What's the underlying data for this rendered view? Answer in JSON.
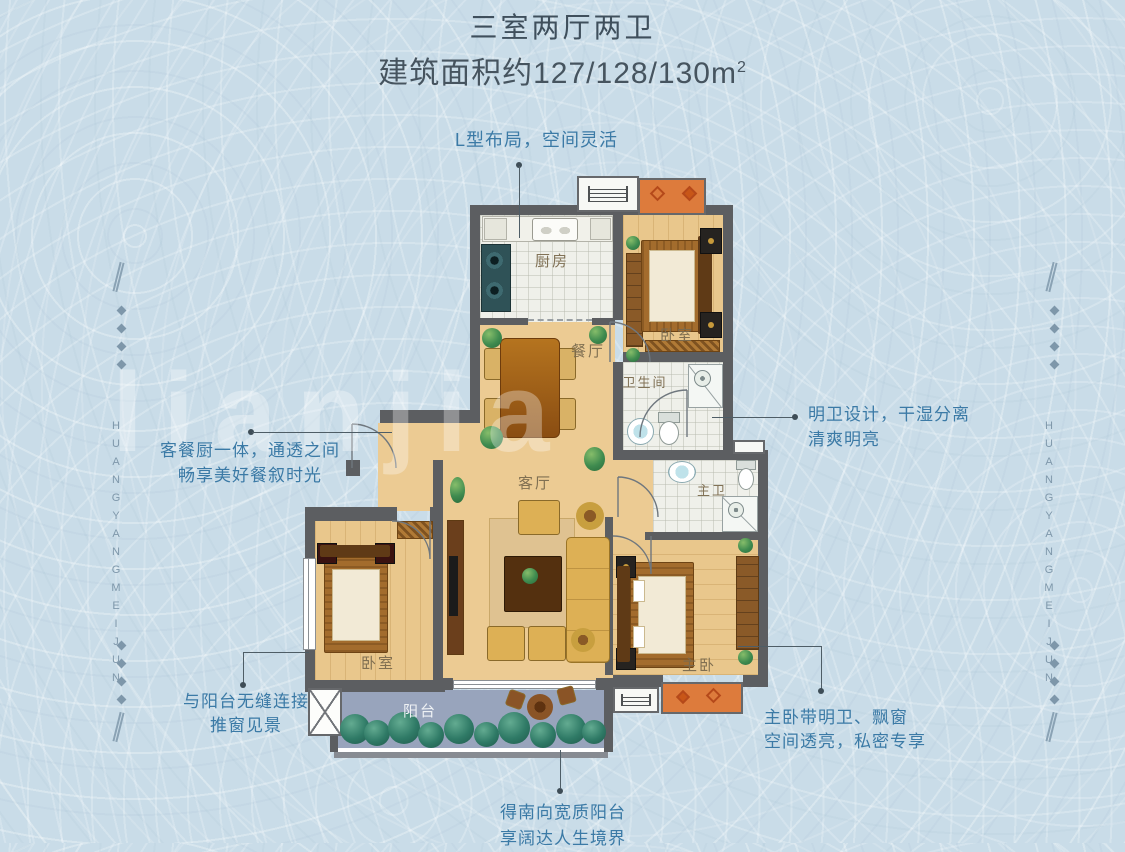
{
  "page": {
    "title": "三室两厅两卫",
    "area_text": "建筑面积约127/128/130m",
    "area_superscript": "2"
  },
  "watermark_text": "lianjia",
  "brand_vertical_text": "HUANGYANGMEIJUN",
  "callouts": {
    "layout": "L型布局，空间灵活",
    "bright_bath_1": "明卫设计，干湿分离",
    "bright_bath_2": "清爽明亮",
    "open_kitchen_1": "客餐厨一体，通透之间",
    "open_kitchen_2": "畅享美好餐叙时光",
    "balcony_link_1": "与阳台无缝连接",
    "balcony_link_2": "推窗见景",
    "master_1": "主卧带明卫、飘窗",
    "master_2": "空间透亮，私密专享",
    "south_balcony_1": "得南向宽质阳台",
    "south_balcony_2": "享阔达人生境界"
  },
  "room_labels": {
    "kitchen": "厨房",
    "dining": "餐厅",
    "bedroom_top": "卧室",
    "bathroom": "卫生间",
    "living": "客厅",
    "master_bath": "主卫",
    "master_bedroom": "主卧",
    "bedroom_left": "卧室",
    "balcony": "阳台"
  },
  "colors": {
    "background": "#c9dce8",
    "title": "#3f4f5c",
    "callout_text": "#3b7aa6",
    "wall": "#5c5e61",
    "wood_floor": "#eccb93",
    "tile_floor": "#eff0ea",
    "balcony_floor": "#98a4bc",
    "bay_window": "#dd7b3c",
    "side_decor": "#7e97aa"
  }
}
